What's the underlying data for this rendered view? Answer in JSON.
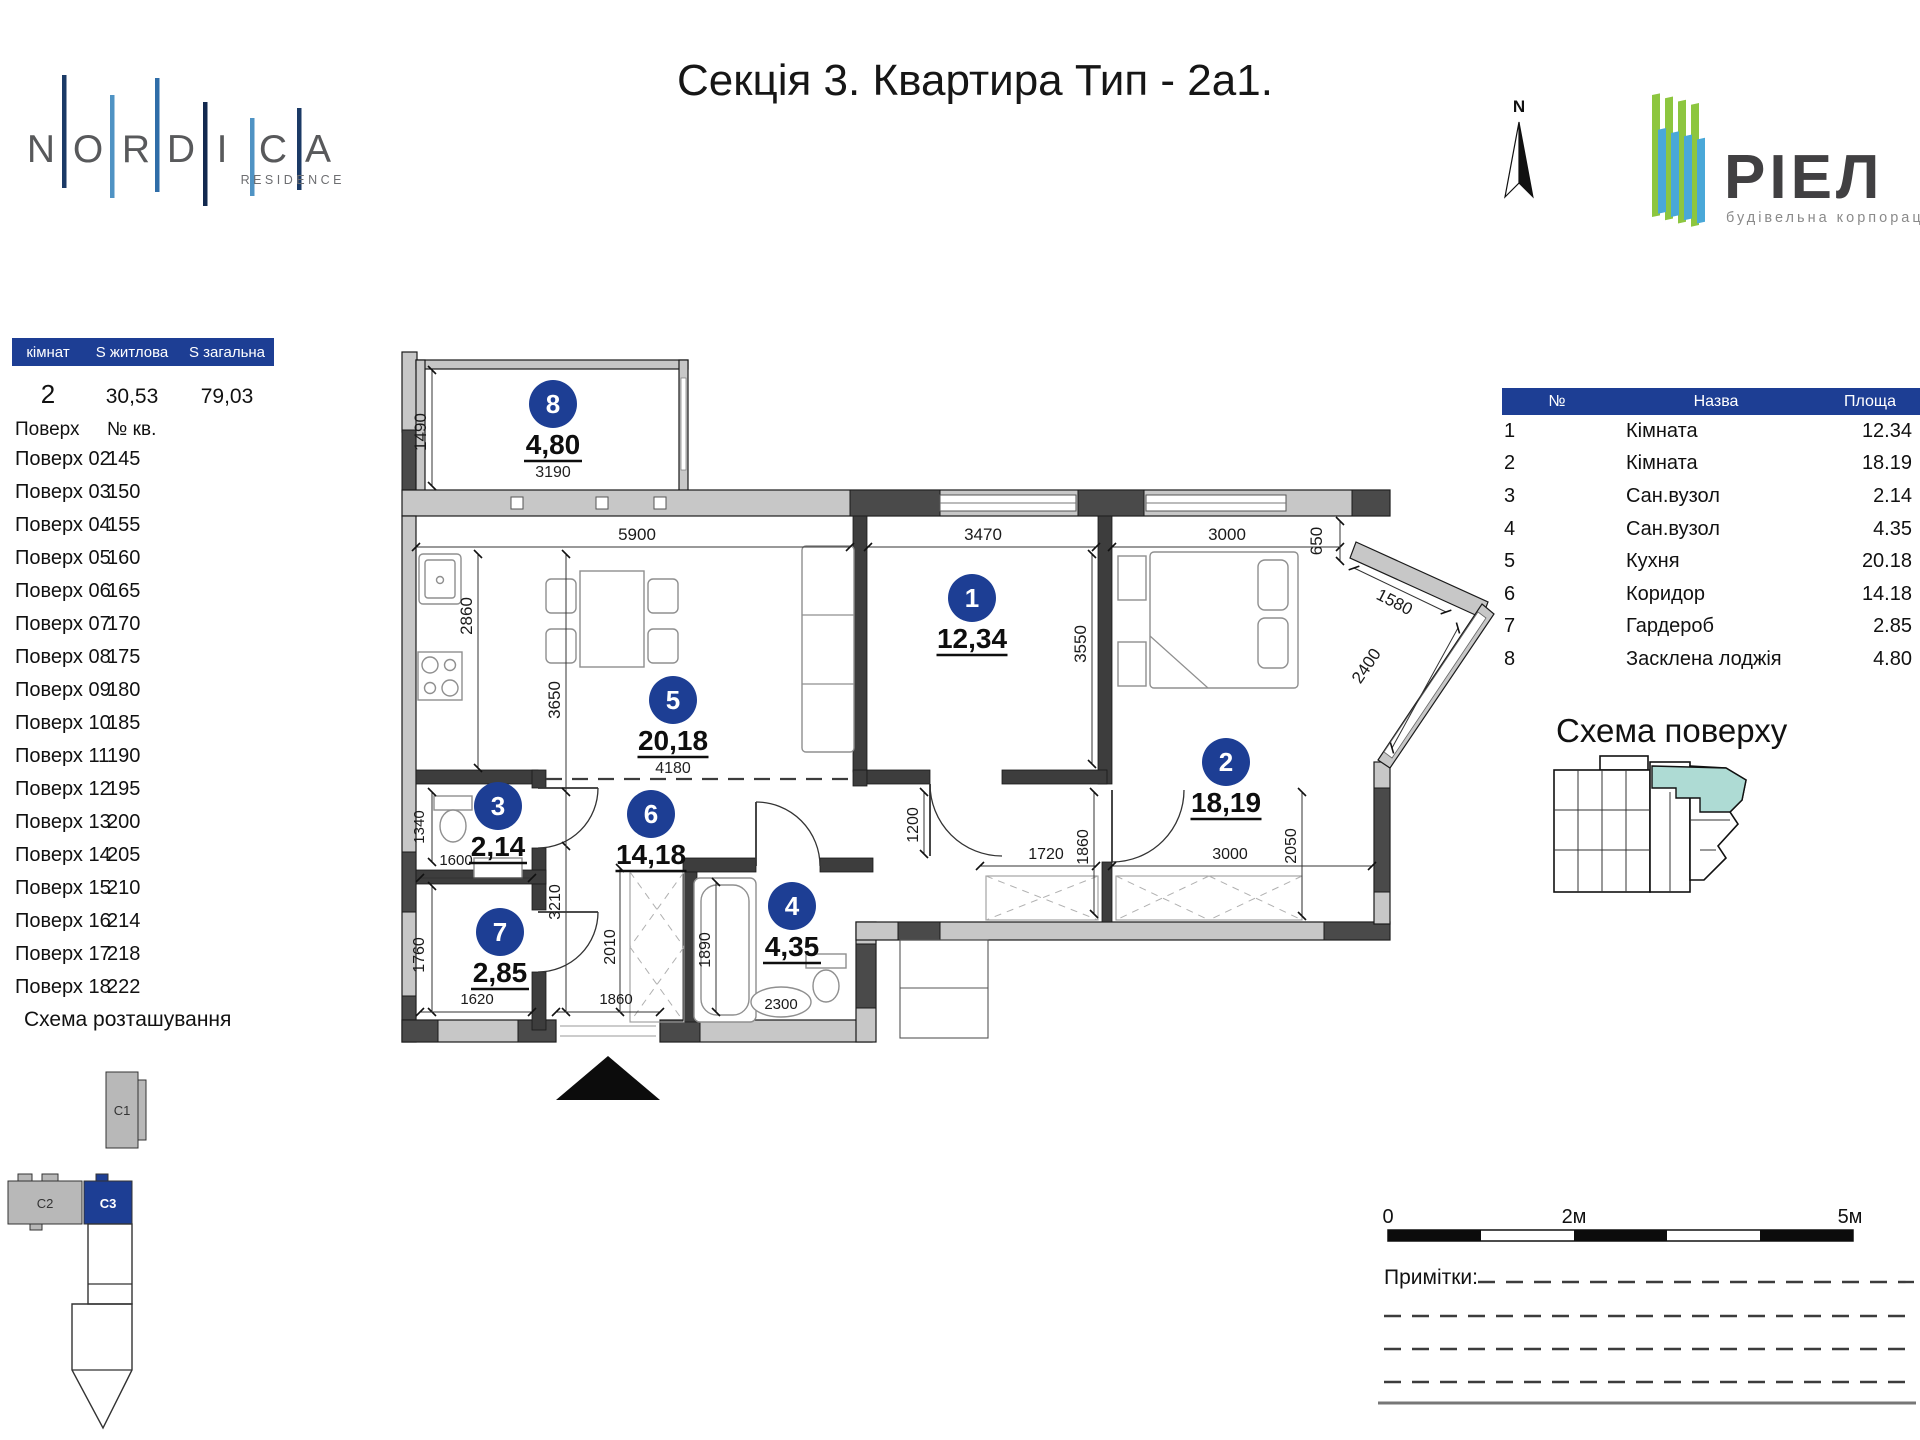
{
  "header": {
    "nordica_letters": [
      "N",
      "O",
      "R",
      "D",
      "I",
      "C",
      "A"
    ],
    "nordica_sub": "RESIDENCE",
    "title": "Секція 3. Квартира Тип - 2а1.",
    "north": "N",
    "riel_name": "РІЕЛ",
    "riel_sub": "будівельна корпорація"
  },
  "colors": {
    "accent_blue": "#1d3e94",
    "scheme_teal": "#aedbd4",
    "logo_green": "#8dc63f",
    "logo_blue": "#49a8d8"
  },
  "summary": {
    "col_rooms": "кімнат",
    "col_living": "S житлова",
    "col_total": "S загальна",
    "rooms": "2",
    "living": "30,53",
    "total": "79,03",
    "floor_col": "Поверх",
    "apt_col": "№ кв.",
    "floors": [
      {
        "f": "Поверх 02",
        "n": "145"
      },
      {
        "f": "Поверх 03",
        "n": "150"
      },
      {
        "f": "Поверх 04",
        "n": "155"
      },
      {
        "f": "Поверх 05",
        "n": "160"
      },
      {
        "f": "Поверх 06",
        "n": "165"
      },
      {
        "f": "Поверх 07",
        "n": "170"
      },
      {
        "f": "Поверх 08",
        "n": "175"
      },
      {
        "f": "Поверх 09",
        "n": "180"
      },
      {
        "f": "Поверх 10",
        "n": "185"
      },
      {
        "f": "Поверх 11",
        "n": "190"
      },
      {
        "f": "Поверх 12",
        "n": "195"
      },
      {
        "f": "Поверх 13",
        "n": "200"
      },
      {
        "f": "Поверх 14",
        "n": "205"
      },
      {
        "f": "Поверх 15",
        "n": "210"
      },
      {
        "f": "Поверх 16",
        "n": "214"
      },
      {
        "f": "Поверх 17",
        "n": "218"
      },
      {
        "f": "Поверх 18",
        "n": "222"
      }
    ],
    "location_title": "Схема розташування",
    "sections": {
      "c1": "C1",
      "c2": "C2",
      "c3": "C3"
    }
  },
  "plan": {
    "rooms": [
      {
        "num": "1",
        "area": "12,34"
      },
      {
        "num": "2",
        "area": "18,19"
      },
      {
        "num": "3",
        "area": "2,14"
      },
      {
        "num": "4",
        "area": "4,35"
      },
      {
        "num": "5",
        "area": "20,18",
        "sub": "4180"
      },
      {
        "num": "6",
        "area": "14,18"
      },
      {
        "num": "7",
        "area": "2,85"
      },
      {
        "num": "8",
        "area": "4,80",
        "sub": "3190"
      }
    ],
    "dims": {
      "lodge_h": "1490",
      "top_kitchen": "5900",
      "top_room1": "3470",
      "top_room2": "3000",
      "corner_650": "650",
      "diag_1580": "1580",
      "diag_2400": "2400",
      "kitchen_2860": "2860",
      "kitchen_3650": "3650",
      "room1_3550": "3550",
      "hall_1200": "1200",
      "closet_1720": "1720",
      "closet_1860": "1860",
      "room2_3000": "3000",
      "room2_2050": "2050",
      "wc3_1340": "1340",
      "wc3_1600": "1600",
      "corr_3210": "3210",
      "corr_2010": "2010",
      "ward_1760": "1760",
      "ward_1620": "1620",
      "entry_1860": "1860",
      "wc4_1890": "1890",
      "wc4_2300": "2300"
    }
  },
  "room_table": {
    "headers": [
      "№",
      "Назва",
      "Площа"
    ],
    "rows": [
      {
        "n": "1",
        "name": "Кімната",
        "area": "12.34"
      },
      {
        "n": "2",
        "name": "Кімната",
        "area": "18.19"
      },
      {
        "n": "3",
        "name": "Сан.вузол",
        "area": "2.14"
      },
      {
        "n": "4",
        "name": "Сан.вузол",
        "area": "4.35"
      },
      {
        "n": "5",
        "name": "Кухня",
        "area": "20.18"
      },
      {
        "n": "6",
        "name": "Коридор",
        "area": "14.18"
      },
      {
        "n": "7",
        "name": "Гардероб",
        "area": "2.85"
      },
      {
        "n": "8",
        "name": "Засклена лоджія",
        "area": "4.80"
      }
    ]
  },
  "floor_scheme_title": "Схема поверху",
  "footer": {
    "scale_0": "0",
    "scale_2": "2м",
    "scale_5": "5м",
    "notes": "Примітки:"
  }
}
